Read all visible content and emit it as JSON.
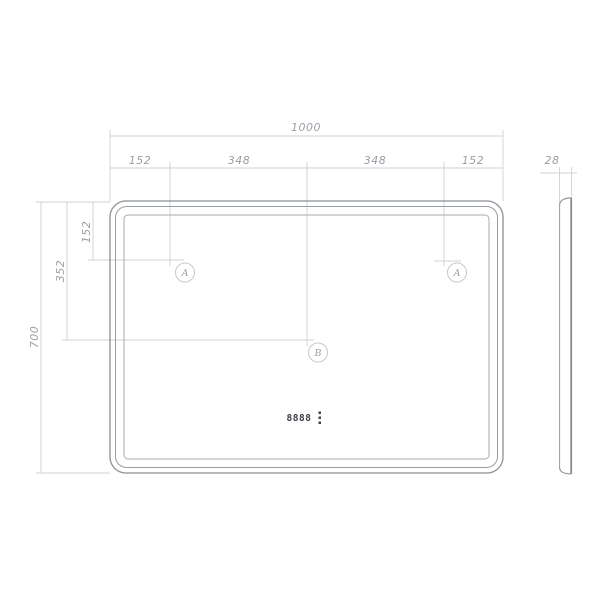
{
  "front_view": {
    "dim_width_total": "1000",
    "dim_width_segments": [
      "152",
      "348",
      "348",
      "152"
    ],
    "dim_height_total": "700",
    "dim_height_mid": "352",
    "dim_height_top": "152",
    "markers": {
      "a_left": "A",
      "a_right": "A",
      "b": "B"
    },
    "clock_display": "8888"
  },
  "side_view": {
    "dim_thickness": "28"
  },
  "colors": {
    "background": "#ffffff",
    "dimension_lines": "#cdd1d5",
    "outline": "#8b9095",
    "dimension_text": "#9aa0a6",
    "clock_text": "#3f4347"
  }
}
